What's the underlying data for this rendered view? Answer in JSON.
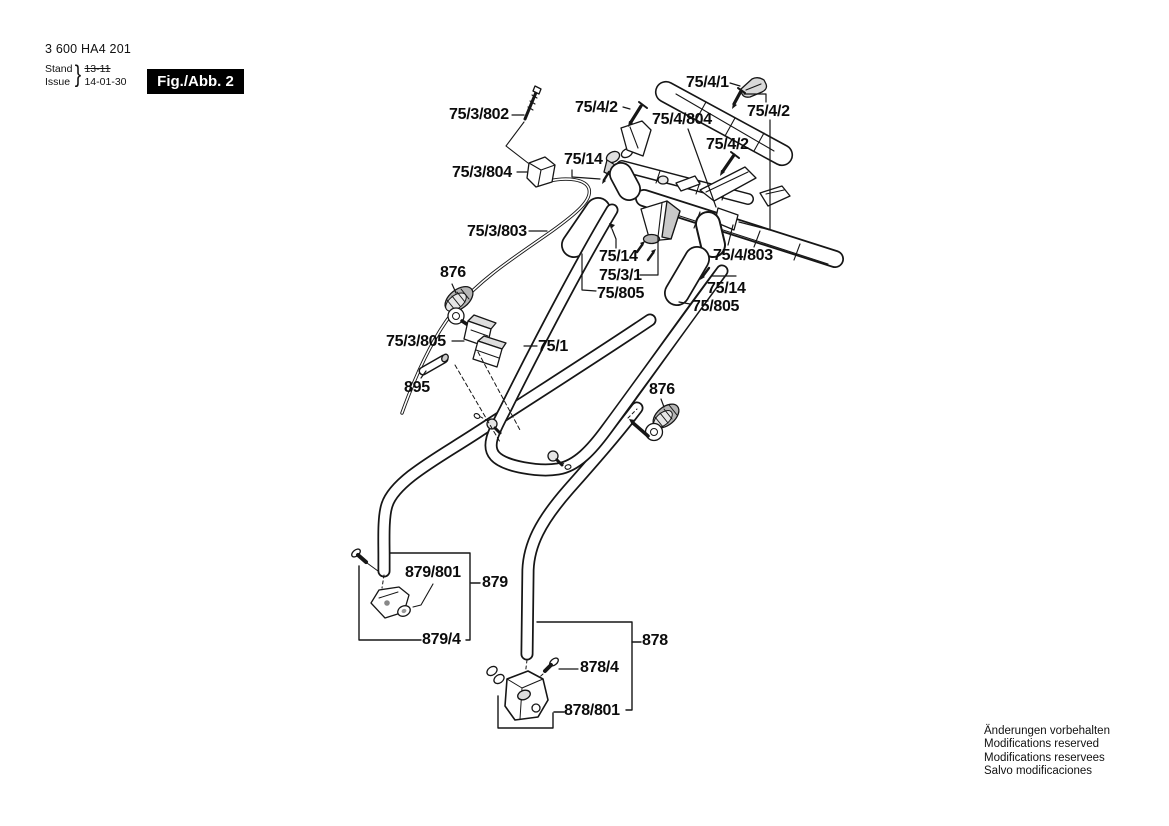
{
  "document": {
    "part_number": "3 600 HA4 201",
    "revision": {
      "stand_label": "Stand",
      "issue_label": "Issue",
      "brace": "}",
      "old_date": "13-11",
      "new_date": "14-01-30"
    },
    "figure_label": "Fig./Abb. 2"
  },
  "footer_notes": [
    "Änderungen vorbehalten",
    "Modifications reserved",
    "Modifications reservees",
    "Salvo modificaciones"
  ],
  "part_labels": [
    {
      "ref": "75/4/1",
      "text": "75/4/1"
    },
    {
      "ref": "75/4/2",
      "text": "75/4/2"
    },
    {
      "ref": "75/4/2",
      "text": "75/4/2"
    },
    {
      "ref": "75/4/804",
      "text": "75/4/804"
    },
    {
      "ref": "75/4/2",
      "text": "75/4/2"
    },
    {
      "ref": "75/14",
      "text": "75/14"
    },
    {
      "ref": "75/3/802",
      "text": "75/3/802"
    },
    {
      "ref": "75/3/804",
      "text": "75/3/804"
    },
    {
      "ref": "75/3/803",
      "text": "75/3/803"
    },
    {
      "ref": "75/14",
      "text": "75/14"
    },
    {
      "ref": "75/3/1",
      "text": "75/3/1"
    },
    {
      "ref": "75/805",
      "text": "75/805"
    },
    {
      "ref": "75/4/803",
      "text": "75/4/803"
    },
    {
      "ref": "75/14",
      "text": "75/14"
    },
    {
      "ref": "75/805",
      "text": "75/805"
    },
    {
      "ref": "876",
      "text": "876"
    },
    {
      "ref": "75/3/805",
      "text": "75/3/805"
    },
    {
      "ref": "75/1",
      "text": "75/1"
    },
    {
      "ref": "895",
      "text": "895"
    },
    {
      "ref": "876",
      "text": "876"
    },
    {
      "ref": "879/801",
      "text": "879/801"
    },
    {
      "ref": "879",
      "text": "879"
    },
    {
      "ref": "879/4",
      "text": "879/4"
    },
    {
      "ref": "878",
      "text": "878"
    },
    {
      "ref": "878/4",
      "text": "878/4"
    },
    {
      "ref": "878/801",
      "text": "878/801"
    }
  ]
}
